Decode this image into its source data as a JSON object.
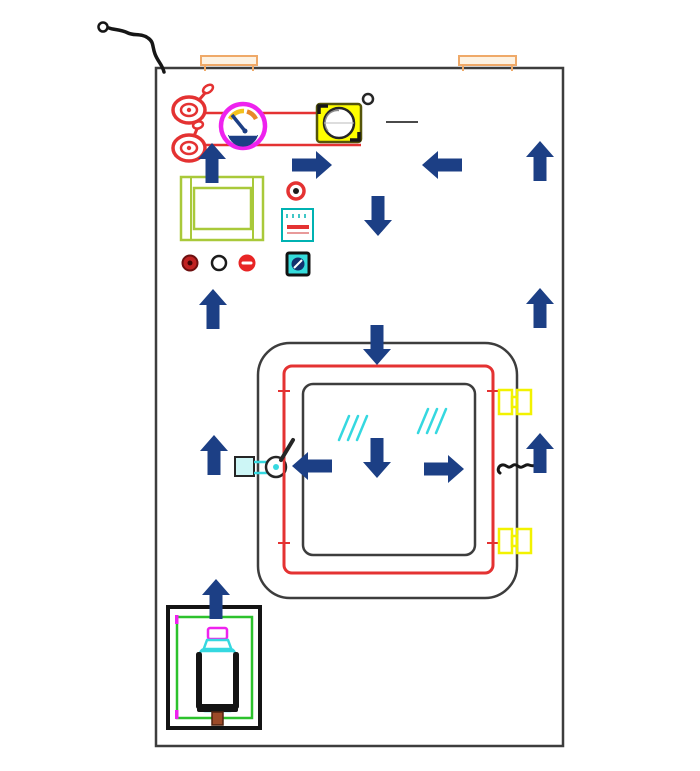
{
  "diagram": {
    "type": "cad-schematic",
    "description": "Technical CAD drawing of an equipment cabinet door panel: top hinges, power cable, two red valves with supply lines, pressure gauge, blower, filter grille, indicator lights, power switch, central gasketed viewing window with handle, latch and yellow hinges, bottle compartment, and airflow direction arrows",
    "components": [
      {
        "id": "door-panel",
        "kind": "panel outline"
      },
      {
        "id": "power-cable",
        "kind": "cable with ring connector, top-left"
      },
      {
        "id": "hinge-top-left",
        "kind": "orange hinge bracket"
      },
      {
        "id": "hinge-top-right",
        "kind": "orange hinge bracket"
      },
      {
        "id": "valve-top",
        "kind": "red valve with handle"
      },
      {
        "id": "valve-bottom",
        "kind": "red valve with handle"
      },
      {
        "id": "supply-line-1",
        "kind": "red pipe line"
      },
      {
        "id": "supply-line-2",
        "kind": "red pipe line"
      },
      {
        "id": "pressure-gauge",
        "kind": "magenta-ring dial gauge with navy needle"
      },
      {
        "id": "fan-blower",
        "kind": "yellow blower box with port and leader line"
      },
      {
        "id": "filter-grille",
        "kind": "yellow-green framed grille"
      },
      {
        "id": "red-knob",
        "kind": "small red knob"
      },
      {
        "id": "controller-box",
        "kind": "teal box with red display bar"
      },
      {
        "id": "indicator-light-1",
        "kind": "dark red pilot light"
      },
      {
        "id": "indicator-light-2",
        "kind": "white pilot light"
      },
      {
        "id": "emergency-stop-button",
        "kind": "red button with white bar"
      },
      {
        "id": "power-switch",
        "kind": "cyan square switch"
      },
      {
        "id": "window-assembly",
        "kind": "rounded window: outer frame, red gasket, glass pane with cyan hatch"
      },
      {
        "id": "window-handle",
        "kind": "latch handle with lever, left of window"
      },
      {
        "id": "door-latch",
        "kind": "coiled latch, right of window"
      },
      {
        "id": "window-hinge-1",
        "kind": "yellow hinge, right of window"
      },
      {
        "id": "window-hinge-2",
        "kind": "yellow hinge, right of window"
      },
      {
        "id": "bottle-cabinet",
        "kind": "black/green framed compartment with gas bottle"
      }
    ],
    "arrows": [
      {
        "direction": "up",
        "x": 212,
        "y": 163
      },
      {
        "direction": "right",
        "x": 312,
        "y": 165
      },
      {
        "direction": "left",
        "x": 442,
        "y": 165
      },
      {
        "direction": "up",
        "x": 540,
        "y": 161
      },
      {
        "direction": "down",
        "x": 378,
        "y": 216
      },
      {
        "direction": "up",
        "x": 213,
        "y": 309
      },
      {
        "direction": "up",
        "x": 540,
        "y": 308
      },
      {
        "direction": "down",
        "x": 377,
        "y": 345
      },
      {
        "direction": "up",
        "x": 214,
        "y": 455
      },
      {
        "direction": "left",
        "x": 312,
        "y": 466
      },
      {
        "direction": "down",
        "x": 377,
        "y": 458
      },
      {
        "direction": "right",
        "x": 444,
        "y": 469
      },
      {
        "direction": "up",
        "x": 540,
        "y": 453
      },
      {
        "direction": "up",
        "x": 216,
        "y": 599
      }
    ]
  },
  "colors": {
    "arrow": "#1c3f85",
    "red": "#e43232",
    "magenta": "#ee22ee",
    "yellow": "#f2f200",
    "yellow-fill": "#ffff00",
    "green": "#2cc22c",
    "yellowgreen": "#a9c93a",
    "cyan": "#35d8e0",
    "teal": "#00b2b2",
    "orange": "#efa968",
    "outline": "#3d3d3d",
    "black": "#161616",
    "brown": "#9c4a28",
    "bg": "#ffffff"
  }
}
